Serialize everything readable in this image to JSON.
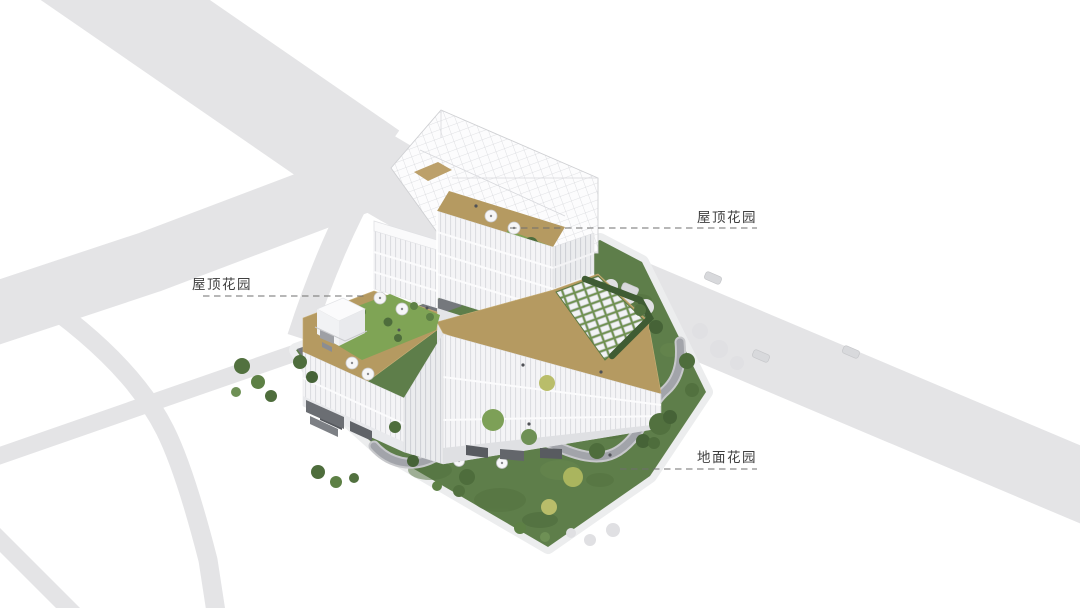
{
  "figure": {
    "kind": "architectural-axonometric-site-rendering",
    "background": "#ffffff",
    "subject": "office building with roof gardens and ground garden"
  },
  "labels": {
    "roof_garden_tower": "屋顶花园",
    "roof_garden_podium": "屋顶花园",
    "ground_garden": "地面花园"
  },
  "palette": {
    "road": "#e4e4e6",
    "sidewalk": "#ecedee",
    "site_lawn": "#5e7e4a",
    "roof_lawn": "#7fa455",
    "terrace_tan": "#b59a61",
    "building_light": "#f4f4f6",
    "building_shade": "#eaebee",
    "pergola_line": "#d7d8dc",
    "path_gray": "#a2a4aa",
    "entry_drive": "#75787d",
    "hedge_green": "#3f5c33",
    "tree_dark": "#4e6d3c",
    "tree_mid": "#5d8045",
    "tree_yellow": "#b9bd6a",
    "ghost_tree": "#e0e0e3",
    "leader_line": "#6f6f6f",
    "label_text": "#3f3f3f"
  }
}
